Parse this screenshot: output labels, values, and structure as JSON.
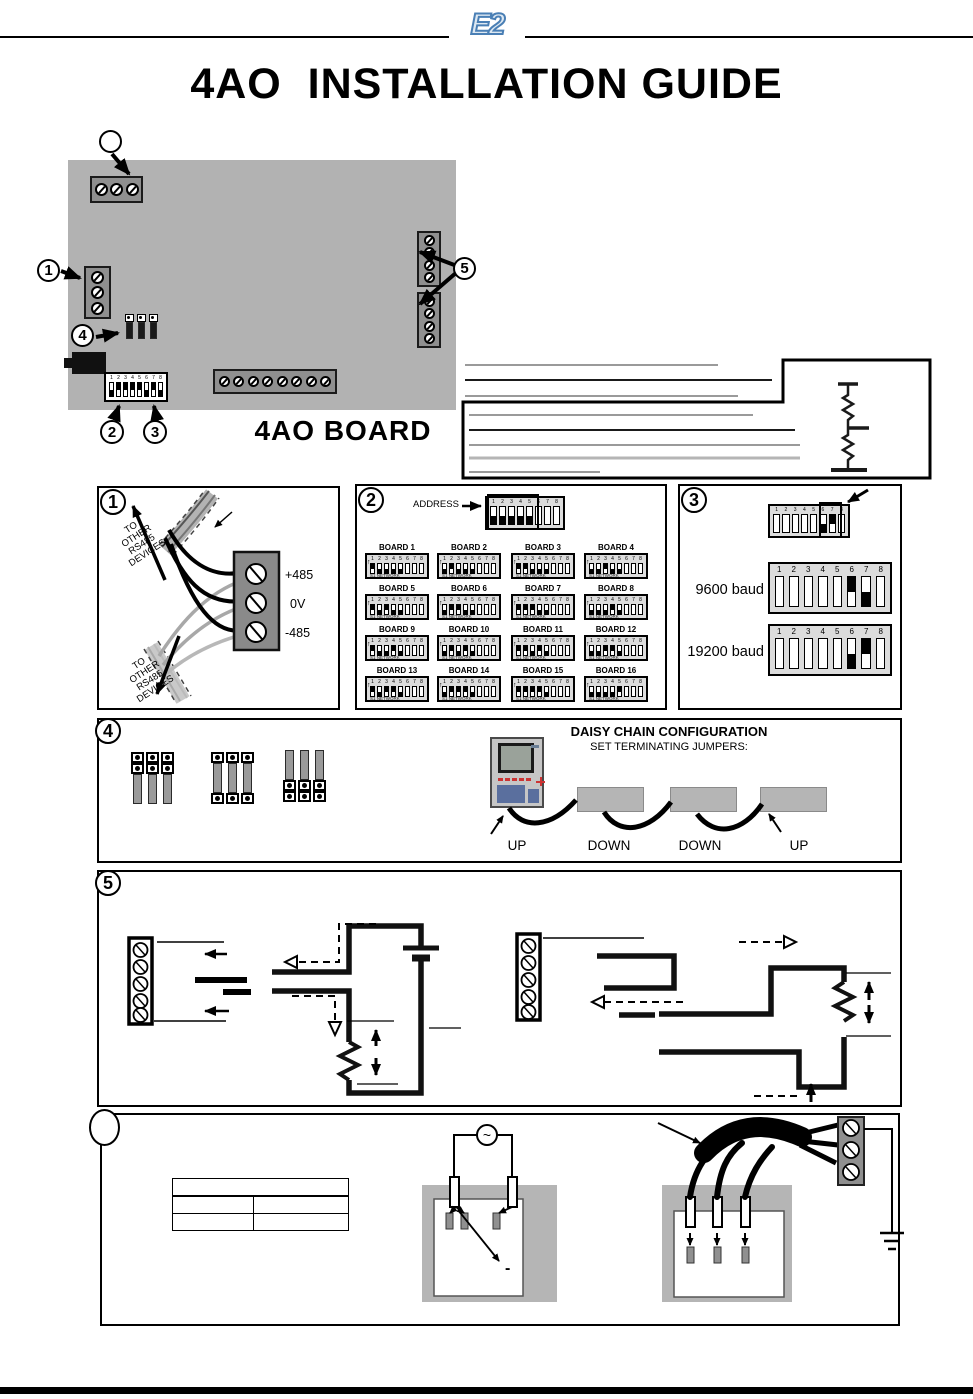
{
  "header": {
    "logo": "E2",
    "title": "4AO  INSTALLATION GUIDE"
  },
  "board": {
    "label": "4AO BOARD"
  },
  "callouts": {
    "c1": "1",
    "c2": "2",
    "c3": "3",
    "c4": "4",
    "c5": "5",
    "power": ""
  },
  "dip_numbers": [
    "1",
    "2",
    "3",
    "4",
    "5",
    "6",
    "7",
    "8"
  ],
  "section1": {
    "number": "1",
    "to_other_lines": [
      "TO",
      "OTHER",
      "RS485",
      "DEVICES"
    ],
    "terminals": [
      "+485",
      "0V",
      "-485"
    ]
  },
  "section2": {
    "number": "2",
    "address_label": "ADDRESS",
    "address_pattern": "dddddnnn",
    "network_label": "S1 NETWORK",
    "boards": [
      {
        "name": "BOARD 1",
        "pattern": "uddddnnn"
      },
      {
        "name": "BOARD 2",
        "pattern": "dudddnnn"
      },
      {
        "name": "BOARD 3",
        "pattern": "uudddnnn"
      },
      {
        "name": "BOARD 4",
        "pattern": "dduddnnn"
      },
      {
        "name": "BOARD 5",
        "pattern": "ududdnnn"
      },
      {
        "name": "BOARD 6",
        "pattern": "duuddnnn"
      },
      {
        "name": "BOARD 7",
        "pattern": "uuuddnnn"
      },
      {
        "name": "BOARD 8",
        "pattern": "dddudnnn"
      },
      {
        "name": "BOARD 9",
        "pattern": "uddudnnn"
      },
      {
        "name": "BOARD 10",
        "pattern": "dududnnn"
      },
      {
        "name": "BOARD 11",
        "pattern": "uududnnn"
      },
      {
        "name": "BOARD 12",
        "pattern": "dduudnnn"
      },
      {
        "name": "BOARD 13",
        "pattern": "uduudnnn"
      },
      {
        "name": "BOARD 14",
        "pattern": "duuudnnn"
      },
      {
        "name": "BOARD 15",
        "pattern": "uuuudnnn"
      },
      {
        "name": "BOARD 16",
        "pattern": "ddddunnn"
      }
    ]
  },
  "section3": {
    "number": "3",
    "top_pattern": "nnnnndun",
    "options": [
      {
        "label": "9600 baud",
        "pattern": "nnnnnudn"
      },
      {
        "label": "19200 baud",
        "pattern": "nnnnndun"
      }
    ]
  },
  "section4": {
    "number": "4",
    "title": "DAISY CHAIN CONFIGURATION",
    "subtitle": "SET TERMINATING JUMPERS:",
    "positions": [
      "UP",
      "DOWN",
      "DOWN",
      "UP"
    ]
  },
  "section5": {
    "number": "5"
  },
  "section6": {
    "ac_symbol": "~",
    "minus_symbol": "-"
  },
  "board_dip_pattern": "duuuudud",
  "colors": {
    "logo_blue": "#4a7fb5",
    "board_gray": "#b2b2b2",
    "terminal_gray": "#8f8f8f",
    "led_red": "#cc3333",
    "keypad_blue": "#5a6f9e"
  }
}
